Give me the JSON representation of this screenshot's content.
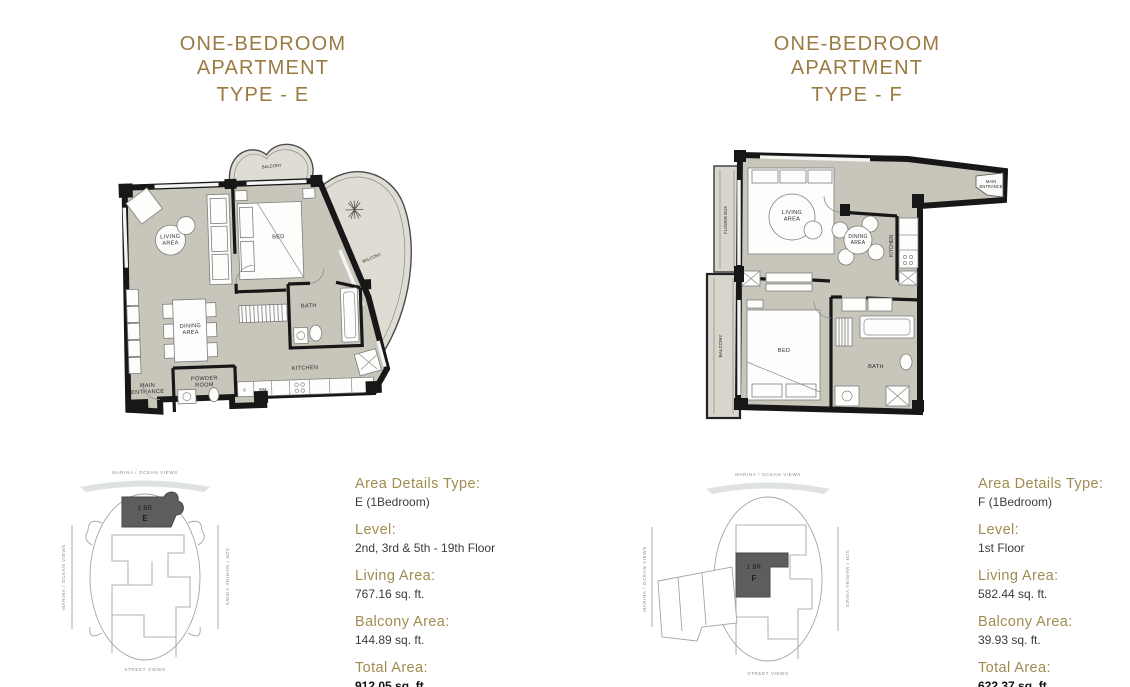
{
  "colors": {
    "gold_title": "#9b7a42",
    "gold_label": "#a08c50",
    "wall_black": "#171717",
    "floor_beige": "#c8c5ba",
    "balcony_gray": "#dedcd3",
    "unit_highlight": "#5d5d5d",
    "keyplan_gray": "#9a9a9a"
  },
  "panels": [
    {
      "title_line1": "ONE-BEDROOM APARTMENT",
      "title_line2": "TYPE - E",
      "floorplan": {
        "living": "LIVING AREA",
        "bed": "BED",
        "dining": "DINING AREA",
        "bath": "BATH",
        "kitchen": "KITCHEN",
        "powder": "POWDER ROOM",
        "entrance": "MAIN ENTRANCE",
        "balcony_top": "BALCONY",
        "balcony_side": "BALCONY",
        "fridge": "F",
        "washer": "WM"
      },
      "keyplan": {
        "view_top": "MARINA / OCEAN VIEWS",
        "view_left": "MARINA / OCEAN VIEWS",
        "view_right": "SZR / MARINA VIEWS",
        "view_bottom": "STREET VIEWS",
        "unit_type": "1 BR",
        "unit_letter": "E"
      },
      "details": [
        {
          "label": "Area Details Type:",
          "value": "E (1Bedroom)"
        },
        {
          "label": "Level:",
          "value": "2nd, 3rd & 5th - 19th Floor"
        },
        {
          "label": "Living Area:",
          "value": "767.16 sq. ft."
        },
        {
          "label": "Balcony Area:",
          "value": "144.89 sq. ft."
        },
        {
          "label": "Total Area:",
          "value": "912.05 sq. ft."
        }
      ]
    },
    {
      "title_line1": "ONE-BEDROOM APARTMENT",
      "title_line2": "TYPE - F",
      "floorplan": {
        "living": "LIVING AREA",
        "bed": "BED",
        "dining": "DINING AREA",
        "bath": "BATH",
        "kitchen": "KITCHEN",
        "entrance": "MAIN ENTRANCE",
        "balcony": "BALCONY",
        "flower_box": "FLOWER BOX"
      },
      "keyplan": {
        "view_top": "MARINA / OCEAN VIEWS",
        "view_left": "MARINA / OCEAN VIEWS",
        "view_right": "SZR / MARINA VIEWS",
        "view_bottom": "STREET VIEWS",
        "unit_type": "1 BR",
        "unit_letter": "F"
      },
      "details": [
        {
          "label": "Area Details Type:",
          "value": "F (1Bedroom)"
        },
        {
          "label": "Level:",
          "value": "1st Floor"
        },
        {
          "label": "Living Area:",
          "value": "582.44 sq. ft."
        },
        {
          "label": "Balcony Area:",
          "value": "39.93 sq. ft."
        },
        {
          "label": "Total Area:",
          "value": "622.37 sq. ft."
        }
      ]
    }
  ]
}
